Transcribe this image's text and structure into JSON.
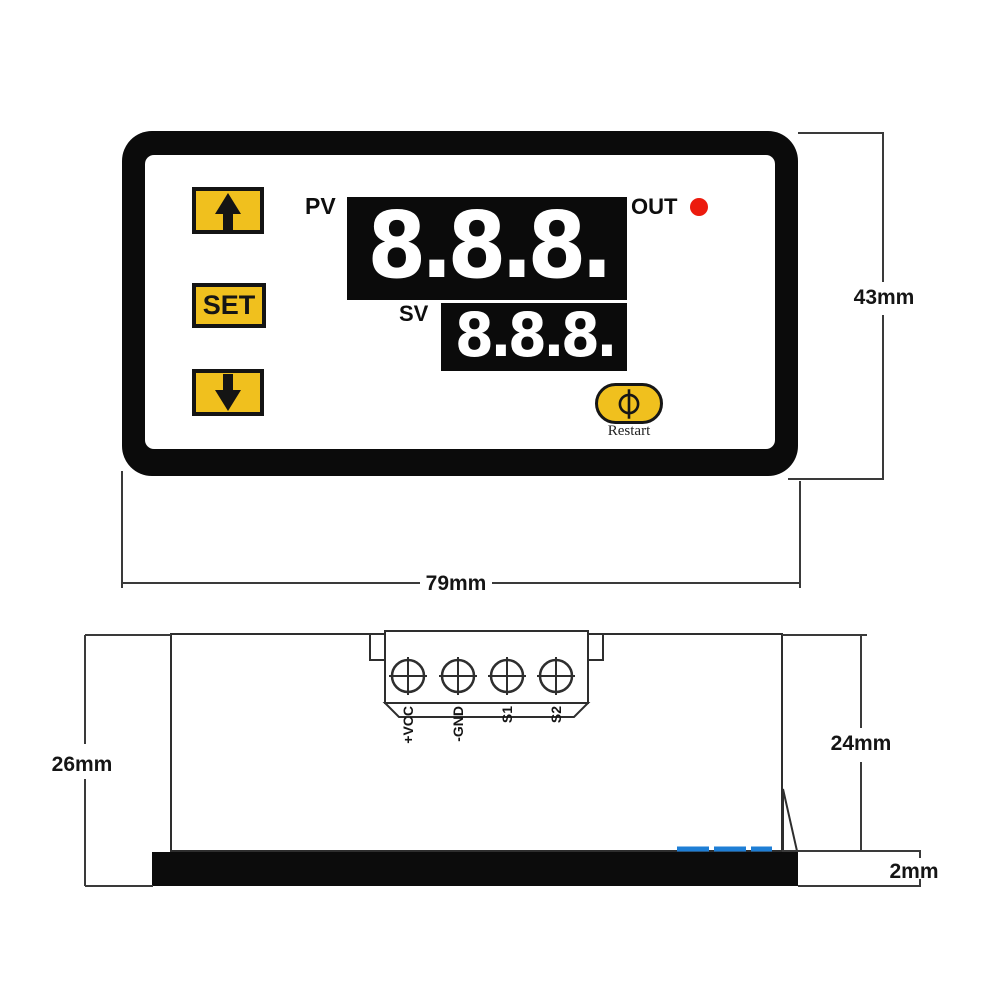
{
  "front_view": {
    "pv_label": "PV",
    "pv_value": "8.8.8.",
    "sv_label": "SV",
    "sv_value": "8.8.8.",
    "out_label": "OUT",
    "set_button_label": "SET",
    "restart_label": "Restart"
  },
  "dimensions": {
    "panel_height": "43mm",
    "panel_width": "79mm",
    "case_total_depth": "26mm",
    "case_body_depth": "24mm",
    "front_bezel_thickness": "2mm"
  },
  "terminals": [
    "+VCC",
    "-GND",
    "S1",
    "S2"
  ],
  "icons": {
    "up_button": "arrow-up-icon",
    "down_button": "arrow-down-icon",
    "restart_button": "power-circle-icon",
    "out_indicator": "led-dot-icon",
    "terminal_screws": "screw-cross-icon"
  },
  "colors": {
    "button_yellow": "#F0C01E",
    "led_red": "#EC1B0E",
    "connector_blue": "#1E7ED5",
    "panel_black": "#0B0B0B"
  }
}
